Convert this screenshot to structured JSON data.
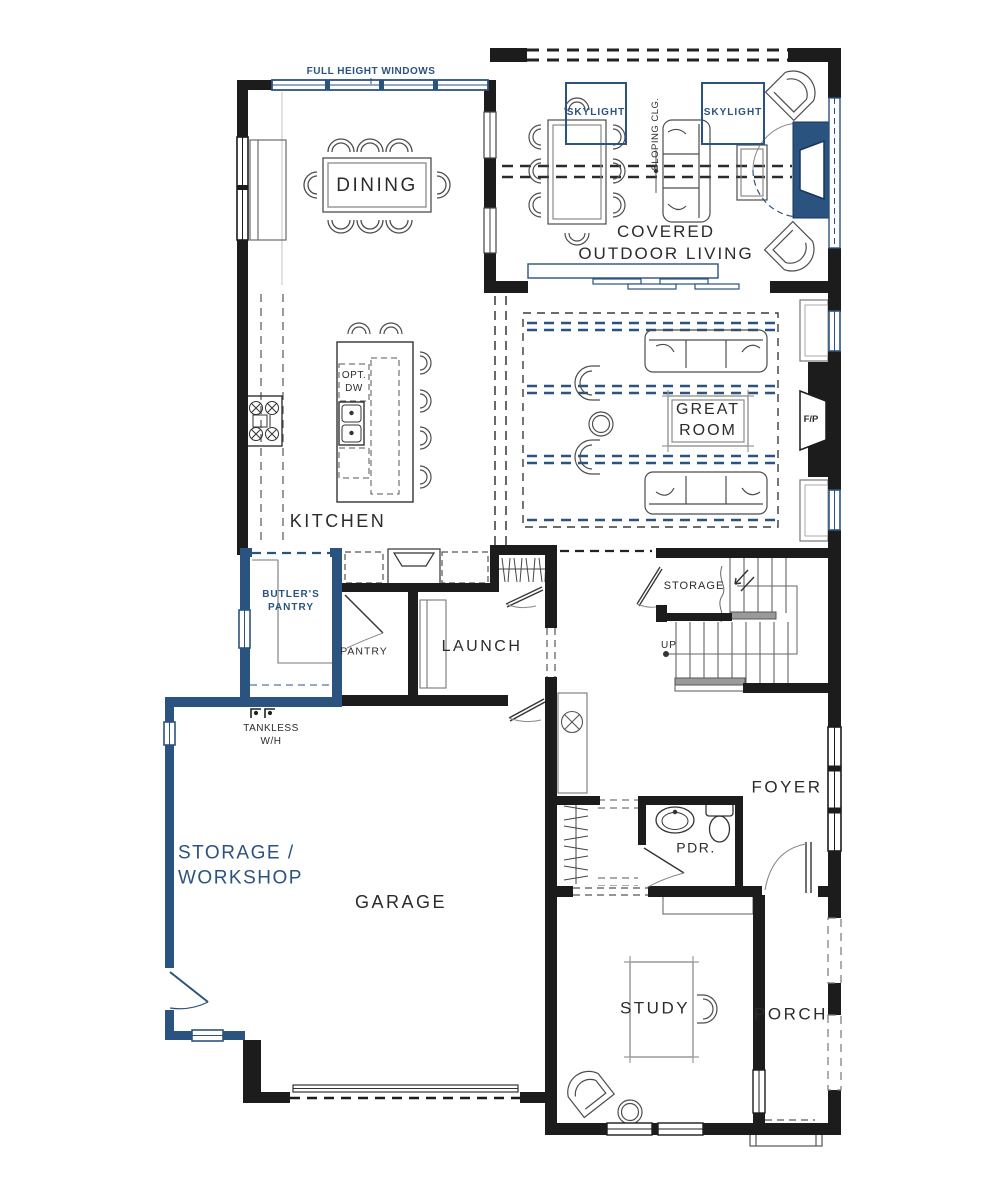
{
  "title": "Residential first floor plan",
  "colors": {
    "accent_blue": "#2b5380",
    "wall_black": "#1c1c1c",
    "furniture_gray": "#4d4d4d",
    "background": "#ffffff"
  },
  "rooms": [
    {
      "id": "dining",
      "label": "DINING"
    },
    {
      "id": "covered-outdoor-living",
      "label": "COVERED\nOUTDOOR LIVING"
    },
    {
      "id": "kitchen",
      "label": "KITCHEN"
    },
    {
      "id": "great-room",
      "label": "GREAT\nROOM"
    },
    {
      "id": "butlers-pantry",
      "label": "BUTLER'S\nPANTRY"
    },
    {
      "id": "pantry",
      "label": "PANTRY"
    },
    {
      "id": "launch",
      "label": "LAUNCH"
    },
    {
      "id": "storage-under-stairs",
      "label": "STORAGE"
    },
    {
      "id": "foyer",
      "label": "FOYER"
    },
    {
      "id": "powder-room",
      "label": "PDR."
    },
    {
      "id": "storage-workshop",
      "label": "STORAGE /\nWORKSHOP"
    },
    {
      "id": "garage",
      "label": "GARAGE"
    },
    {
      "id": "study",
      "label": "STUDY"
    },
    {
      "id": "porch",
      "label": "PORCH"
    }
  ],
  "annotations": [
    {
      "id": "full-height-windows",
      "label": "FULL HEIGHT WINDOWS"
    },
    {
      "id": "skylight-left",
      "label": "SKYLIGHT"
    },
    {
      "id": "skylight-right",
      "label": "SKYLIGHT"
    },
    {
      "id": "sloping-ceiling",
      "label": "SLOPING CLG."
    },
    {
      "id": "fireplace-outdoor",
      "label": "F/P"
    },
    {
      "id": "fireplace-great-room",
      "label": "F/P"
    },
    {
      "id": "optional-dishwasher",
      "label": "OPT.\nDW"
    },
    {
      "id": "tankless-water-heater",
      "label": "TANKLESS\nW/H"
    },
    {
      "id": "stairs-up",
      "label": "UP"
    }
  ]
}
